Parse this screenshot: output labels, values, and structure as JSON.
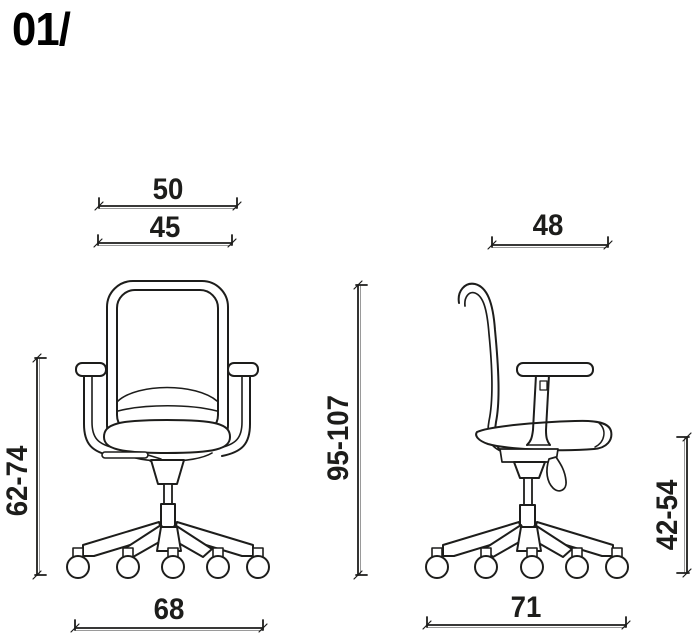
{
  "header": {
    "title": "01/"
  },
  "colors": {
    "line": "#1d1d1b",
    "background": "#ffffff",
    "dim_echo": "#9a9a9a"
  },
  "front_view": {
    "dimensions": {
      "backrest_top_width": "50",
      "backrest_width": "45",
      "armrest_height": "62-74",
      "base_width": "68"
    }
  },
  "side_view": {
    "dimensions": {
      "backrest_width": "48",
      "overall_height": "95-107",
      "seat_height": "42-54",
      "base_depth": "71"
    }
  }
}
